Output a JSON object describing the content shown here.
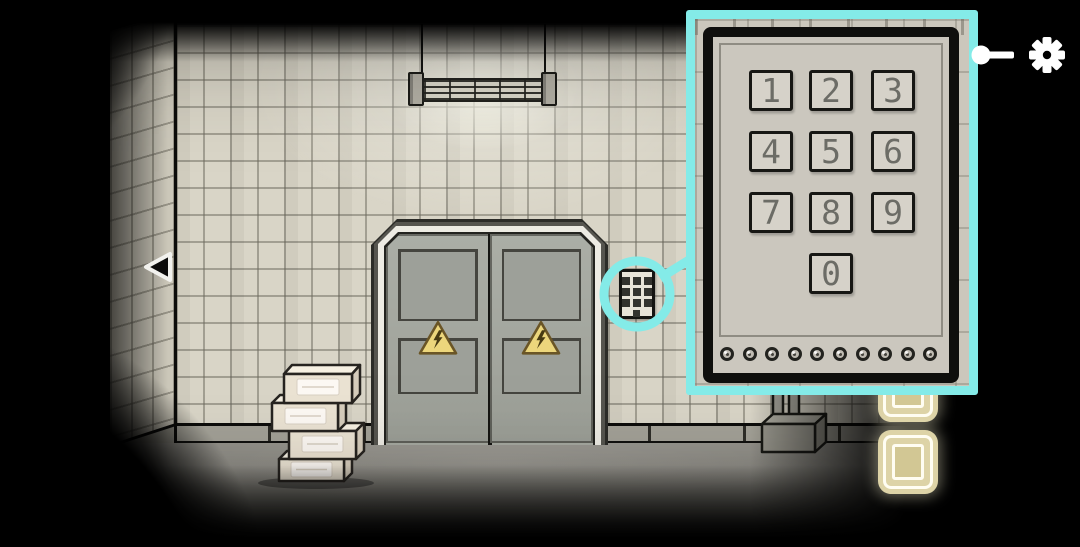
{
  "popup": {
    "keys": [
      "1",
      "2",
      "3",
      "4",
      "5",
      "6",
      "7",
      "8",
      "9",
      "0"
    ],
    "indicator_count": 10,
    "border_color": "#84ebe8"
  },
  "hud": {
    "icons": {
      "settings": "gear-icon",
      "hint": "key-icon",
      "navigate_back": "left-arrow-icon"
    },
    "inventory_slots_visible": 2
  },
  "scene_objects": {
    "door_signs": "high-voltage-triangle-icon",
    "wall_device": "keypad-icon",
    "boxes_in_stack": 4,
    "lamp": "caged-fluorescent-lamp-icon"
  },
  "colors": {
    "highlight": "#84ebe8",
    "wall": "#d9d5c7",
    "floor": "#8e8c85",
    "door": "#a6a9a1",
    "hazard_sign": "#ecd67c",
    "inventory_slot": "#ddd3a7",
    "box": "#ebe3d3",
    "hud_icon": "#ffffff",
    "keypad_digit": "#6c6c66"
  }
}
